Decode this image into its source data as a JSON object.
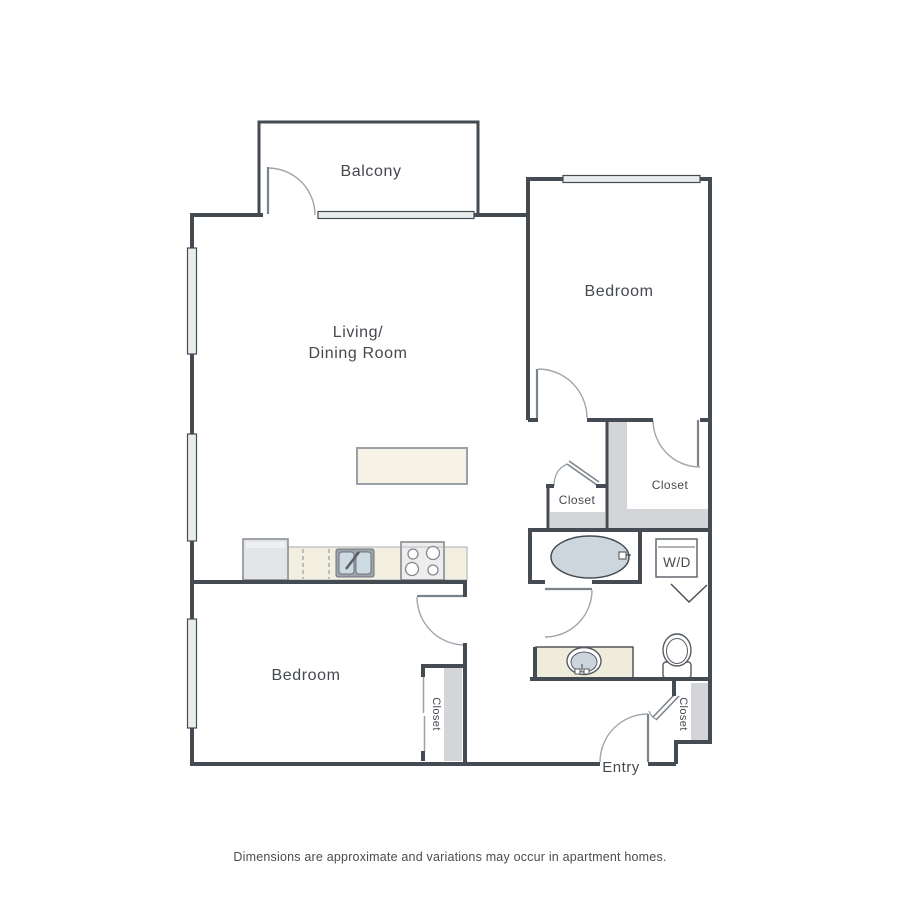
{
  "labels": {
    "balcony": "Balcony",
    "living_line1": "Living/",
    "living_line2": "Dining Room",
    "bedroom_upper": "Bedroom",
    "bedroom_lower": "Bedroom",
    "closet_walk_in": "Closet",
    "closet_hall": "Closet",
    "closet_bedroom": "Closet",
    "closet_entry": "Closet",
    "washer_dryer": "W/D",
    "entry": "Entry"
  },
  "footnote": "Dimensions are approximate and variations may occur in apartment homes.",
  "fixtures": [
    "refrigerator",
    "dishwasher",
    "kitchen-sink",
    "stove",
    "kitchen-island",
    "bathtub",
    "vanity-sink",
    "toilet",
    "washer-dryer-unit"
  ],
  "colors": {
    "wall": "#454b52",
    "window_fill": "#e9eced",
    "wall_shading": "#d3d5d8",
    "counter_beige": "#f2efe1",
    "island_beige": "#f6f3e6",
    "vanity_beige": "#f0ecdb",
    "water_blue": "#cdd6dd",
    "door_arc": "#a0a6ac",
    "text": "#45494e"
  }
}
